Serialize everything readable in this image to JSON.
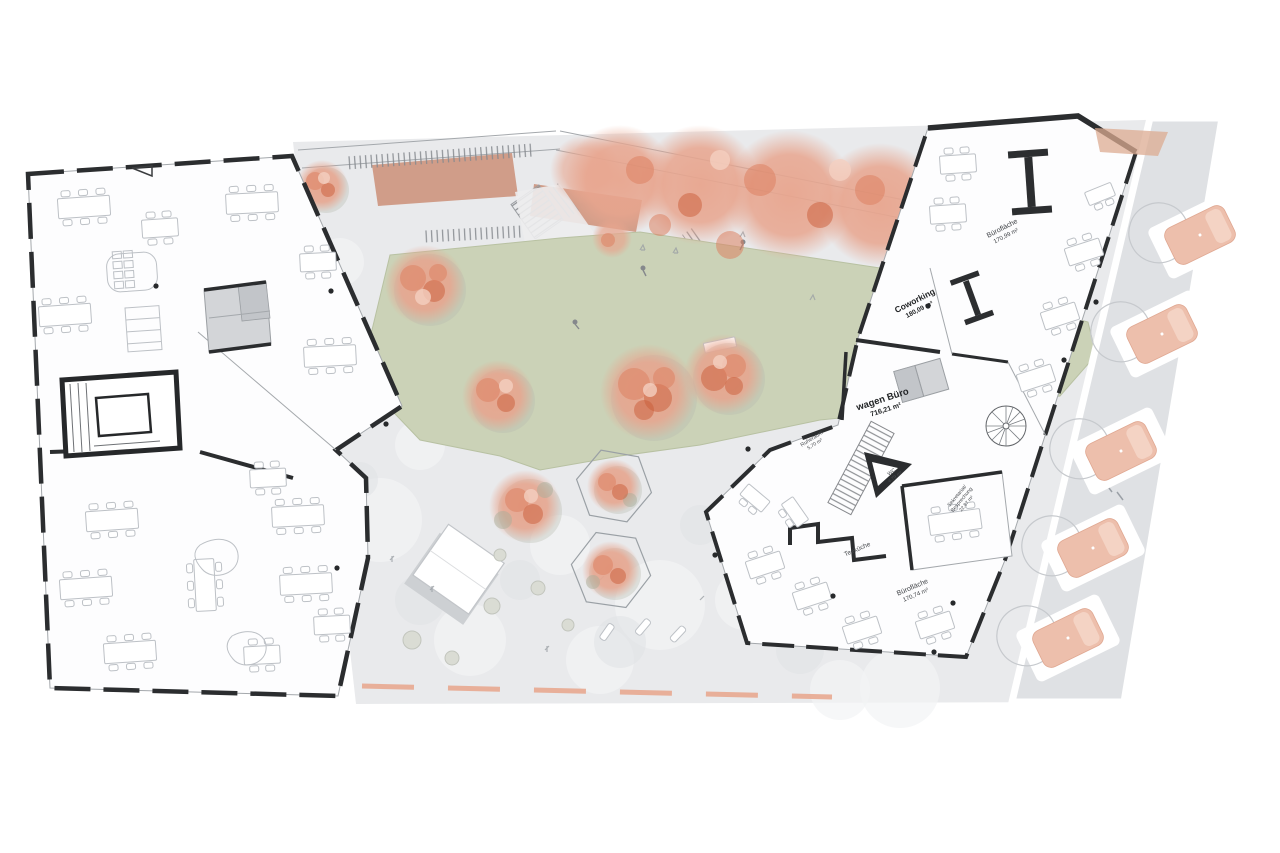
{
  "plan": {
    "kind": "architectural ground-floor site plan",
    "labels": {
      "coworking": {
        "name": "Coworking",
        "area": "180,09 m²"
      },
      "buero_top": {
        "name": "Bürofläche",
        "area": "170,99 m²"
      },
      "wagen_buero": {
        "name": "wagen Büro",
        "area": "716,21 m²"
      },
      "ruheraum": {
        "name": "Ruheraum",
        "area": "5,70 m²"
      },
      "wc": {
        "name": "WC",
        "area": "4,79 m²"
      },
      "sekretariat": {
        "line1": "Sekretariat/",
        "line2": "Besprechung",
        "area": "22,87 m²"
      },
      "teekueche": {
        "name": "Teeküche"
      },
      "buero_bottom": {
        "name": "Bürofläche",
        "area": "170,74 m²"
      }
    }
  },
  "colors": {
    "ground": "#e9eaec",
    "drive": "#dfe1e4",
    "building": "#fdfdfe",
    "wall": "#2b2d2f",
    "line": "#a4a8ac",
    "furn": "#bdc1c6",
    "lawn": "#cbd2b7",
    "lawn_edge": "#b8c1a2",
    "tree_soft": "#e8a58e",
    "tree_mid": "#dd8262",
    "tree_deep": "#c95c38",
    "tree_light": "#f4d0c0",
    "tree_shadow": "#b6b9b0",
    "brick": "#c98a70",
    "brick_light": "#dcab92",
    "car": "#edbfac",
    "car_light": "#f6dacc",
    "curb": "#e7a48b",
    "core": "#d3d5d8",
    "core_dark": "#c2c5c9"
  }
}
